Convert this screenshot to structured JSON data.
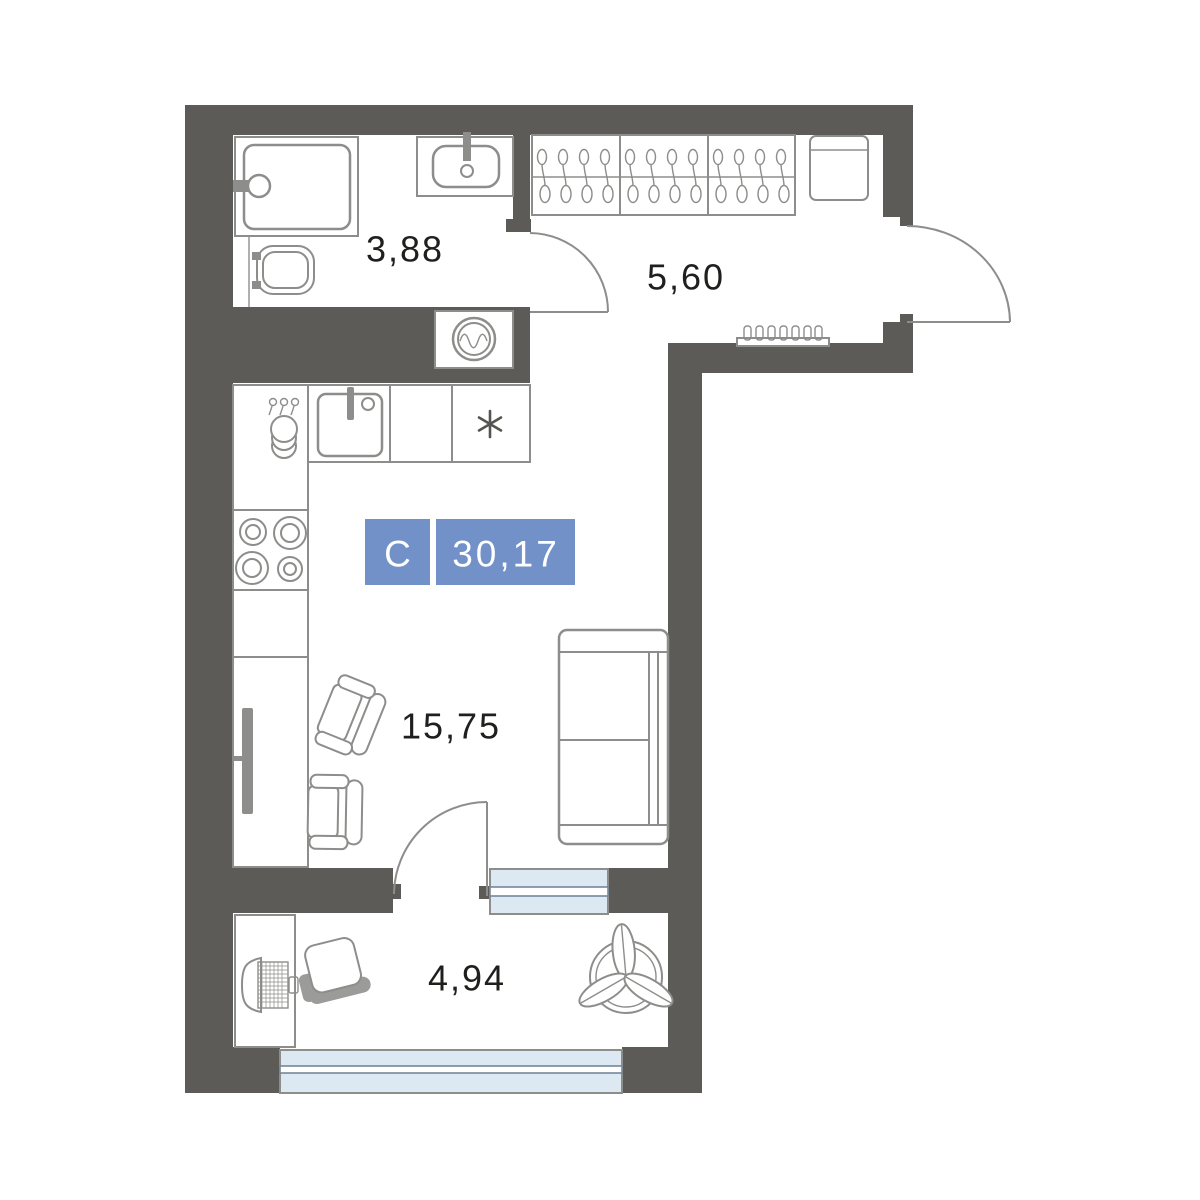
{
  "plan": {
    "title": "Studio apartment floor plan",
    "badge": {
      "type_label": "С",
      "area_value": "30,17",
      "background": "#7191c8",
      "text_color": "#ffffff"
    },
    "rooms": [
      {
        "name": "bathroom",
        "area_label": "3,88"
      },
      {
        "name": "hallway",
        "area_label": "5,60"
      },
      {
        "name": "living-kitchen",
        "area_label": "15,75"
      },
      {
        "name": "balcony",
        "area_label": "4,94"
      }
    ],
    "fixtures": [
      "bathtub-icon",
      "toilet-icon",
      "washbasin-icon",
      "washing-machine-icon",
      "wardrobe-hangers-icon",
      "cabinet-icon",
      "radiator-icon",
      "kitchen-sink-icon",
      "stove-burners-icon",
      "dish-stack-icon",
      "fridge-asterisk-icon",
      "tv-icon",
      "armchair-icon",
      "bed-icon",
      "desk-icon",
      "laptop-icon",
      "office-chair-icon",
      "plant-icon",
      "door-swing-icon",
      "window-icon"
    ],
    "colors": {
      "wall": "#5d5b57",
      "furniture_stroke": "#8d8d8b",
      "window_fill": "#dce8f2",
      "label_text": "#1f1f1d",
      "badge_blue": "#7191c8"
    }
  }
}
